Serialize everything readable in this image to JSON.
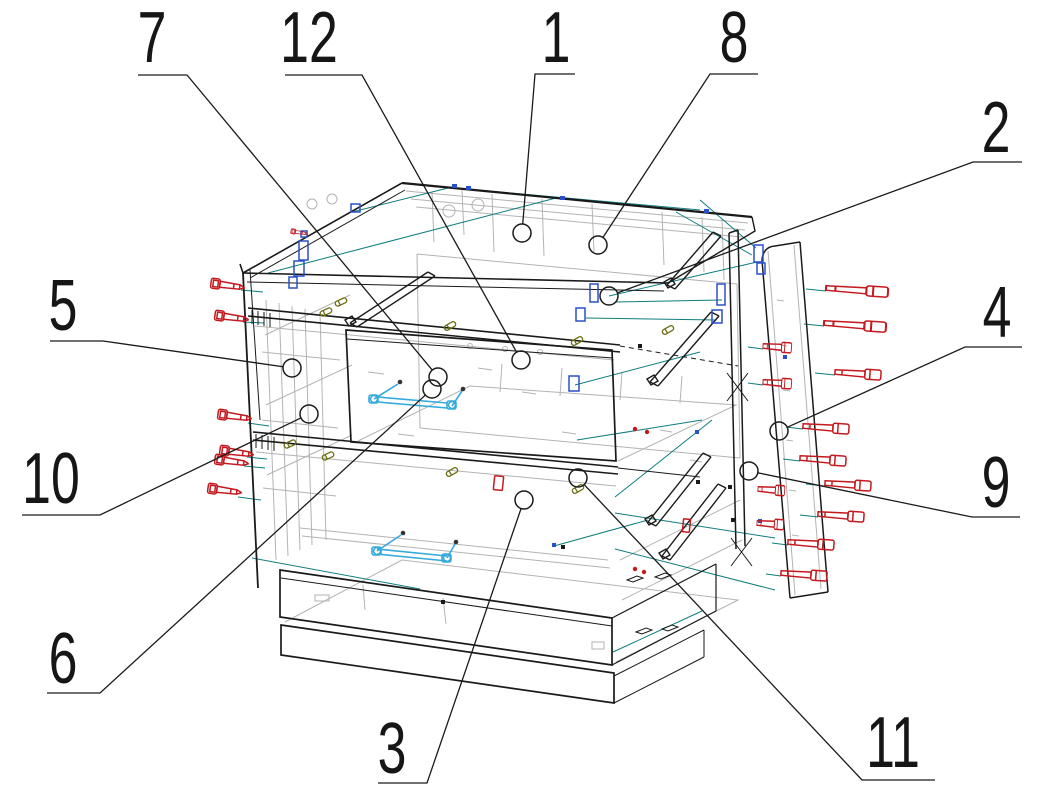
{
  "diagram": {
    "type": "exploded-assembly-drawing",
    "subject": "two-drawer cabinet furniture assembly",
    "background": "#ffffff",
    "callouts": [
      {
        "label": "1",
        "text_x": 556,
        "baseline_y": 62,
        "points": [
          [
            575,
            74
          ],
          [
            535,
            74
          ],
          [
            522,
            233
          ]
        ],
        "circle": {
          "x": 522,
          "y": 233,
          "r": 9
        }
      },
      {
        "label": "2",
        "text_x": 996,
        "baseline_y": 152,
        "points": [
          [
            1022,
            162
          ],
          [
            973,
            162
          ],
          [
            609,
            296
          ]
        ],
        "circle": {
          "x": 609,
          "y": 296,
          "r": 9
        }
      },
      {
        "label": "3",
        "text_x": 392,
        "baseline_y": 773,
        "points": [
          [
            378,
            783
          ],
          [
            427,
            783
          ],
          [
            524,
            500
          ]
        ],
        "circle": {
          "x": 524,
          "y": 500,
          "r": 9
        }
      },
      {
        "label": "4",
        "text_x": 997,
        "baseline_y": 337,
        "points": [
          [
            1022,
            347
          ],
          [
            965,
            347
          ],
          [
            779,
            431
          ]
        ],
        "circle": {
          "x": 779,
          "y": 431,
          "r": 9
        }
      },
      {
        "label": "5",
        "text_x": 63,
        "baseline_y": 330,
        "points": [
          [
            50,
            341
          ],
          [
            103,
            341
          ],
          [
            292,
            368
          ]
        ],
        "circle": {
          "x": 292,
          "y": 368,
          "r": 9
        }
      },
      {
        "label": "6",
        "text_x": 63,
        "baseline_y": 683,
        "points": [
          [
            47,
            693
          ],
          [
            100,
            693
          ],
          [
            432,
            389
          ]
        ],
        "circle": {
          "x": 432,
          "y": 389,
          "r": 9
        }
      },
      {
        "label": "7",
        "text_x": 152,
        "baseline_y": 62,
        "points": [
          [
            138,
            75
          ],
          [
            187,
            75
          ],
          [
            438,
            377
          ]
        ],
        "circle": {
          "x": 438,
          "y": 377,
          "r": 9
        }
      },
      {
        "label": "8",
        "text_x": 734,
        "baseline_y": 62,
        "points": [
          [
            758,
            74
          ],
          [
            710,
            74
          ],
          [
            598,
            245
          ]
        ],
        "circle": {
          "x": 598,
          "y": 245,
          "r": 9
        }
      },
      {
        "label": "9",
        "text_x": 996,
        "baseline_y": 507,
        "points": [
          [
            1020,
            517
          ],
          [
            972,
            517
          ],
          [
            749,
            471
          ]
        ],
        "circle": {
          "x": 749,
          "y": 471,
          "r": 9
        }
      },
      {
        "label": "10",
        "text_x": 51,
        "baseline_y": 503,
        "points": [
          [
            22,
            515
          ],
          [
            100,
            515
          ],
          [
            309,
            414
          ]
        ],
        "circle": {
          "x": 309,
          "y": 414,
          "r": 9
        }
      },
      {
        "label": "11",
        "text_x": 893,
        "baseline_y": 767,
        "points": [
          [
            935,
            780
          ],
          [
            862,
            780
          ],
          [
            578,
            478
          ]
        ],
        "circle": {
          "x": 578,
          "y": 478,
          "r": 9
        }
      },
      {
        "label": "12",
        "text_x": 309,
        "baseline_y": 62,
        "points": [
          [
            285,
            75
          ],
          [
            362,
            75
          ],
          [
            521,
            360
          ]
        ],
        "circle": {
          "x": 521,
          "y": 360,
          "r": 9
        }
      }
    ],
    "colors": {
      "outline": "#1a1a1a",
      "hidden": "#b3b3b3",
      "guide": "#0e7d7d",
      "fastener": "#c41a1f",
      "hardware": "#2850c8",
      "handle": "#35aadc",
      "screwsmall": "#6e6e12",
      "background": "#ffffff"
    },
    "symbols": {
      "fastener": "confirmat-screw-icon",
      "hardware": "cam-lock-icon",
      "handle": "drawer-handle-bracket-icon",
      "screwsmall": "small-screw-icon",
      "guide": "alignment-guide-line",
      "hidden": "hidden-edge-line"
    }
  }
}
